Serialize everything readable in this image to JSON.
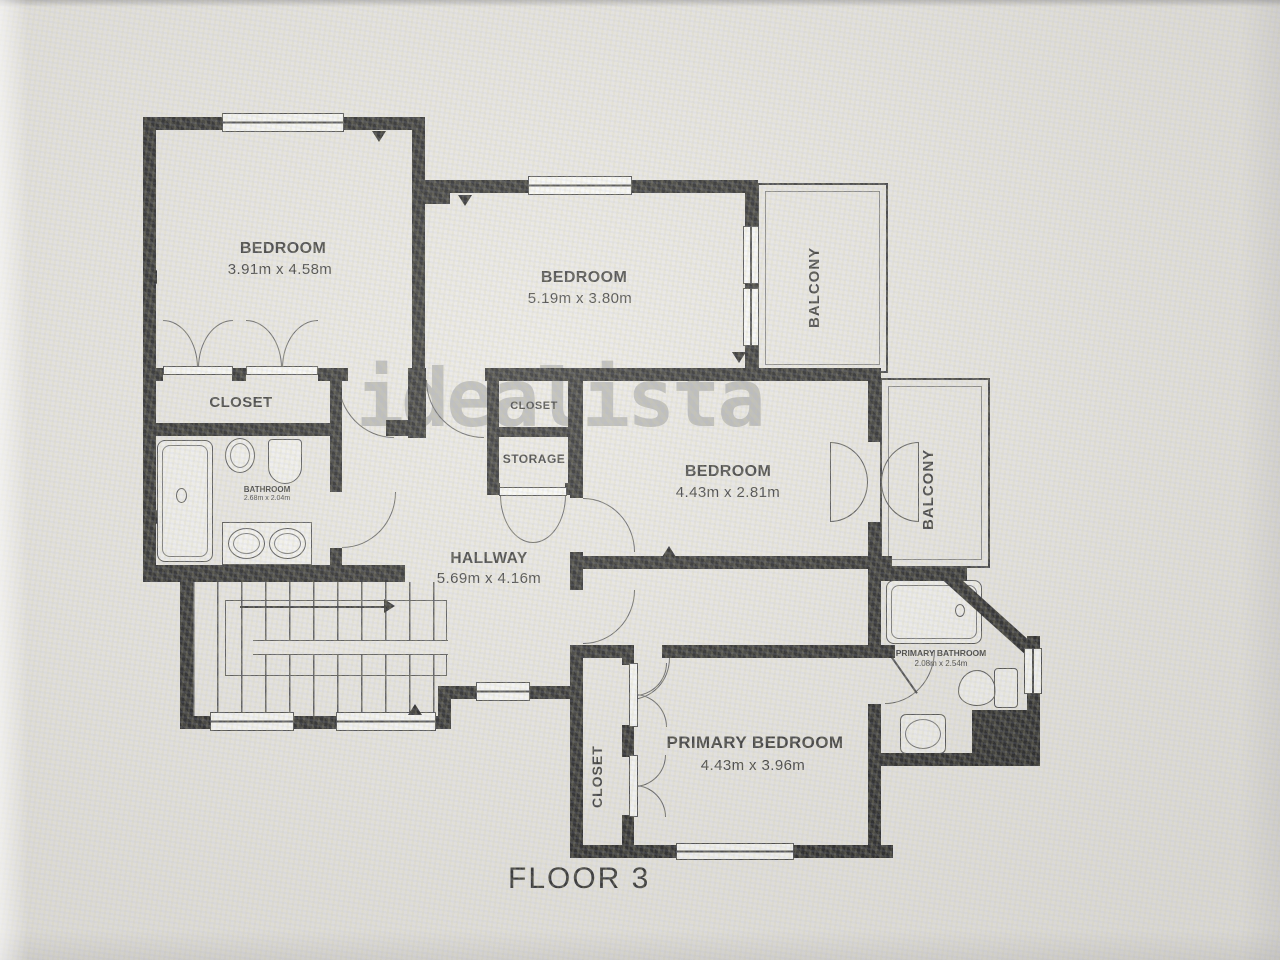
{
  "floor_label": "FLOOR 3",
  "watermark": "idealista",
  "colors": {
    "background": "#e9e7e3",
    "wall": "#1b1b1b",
    "thin_line": "#4a4a4a",
    "text": "#2b2b2b",
    "watermark": "#8f8f8f"
  },
  "rooms": {
    "bedroom_top_left": {
      "name": "BEDROOM",
      "dims": "3.91m x 4.58m"
    },
    "bedroom_top_mid": {
      "name": "BEDROOM",
      "dims": "5.19m x 3.80m"
    },
    "bedroom_right": {
      "name": "BEDROOM",
      "dims": "4.43m x 2.81m"
    },
    "primary_bedroom": {
      "name": "PRIMARY BEDROOM",
      "dims": "4.43m x 3.96m"
    },
    "hallway": {
      "name": "HALLWAY",
      "dims": "5.69m x 4.16m"
    },
    "bathroom": {
      "name": "BATHROOM",
      "dims": "2.68m x 2.04m"
    },
    "primary_bathroom": {
      "name": "PRIMARY BATHROOM",
      "dims": "2.08m x 2.54m"
    },
    "closet_left": {
      "name": "CLOSET"
    },
    "closet_mid": {
      "name": "CLOSET"
    },
    "storage": {
      "name": "STORAGE"
    },
    "closet_primary": {
      "name": "CLOSET"
    },
    "balcony_top": {
      "name": "BALCONY"
    },
    "balcony_right": {
      "name": "BALCONY"
    }
  }
}
